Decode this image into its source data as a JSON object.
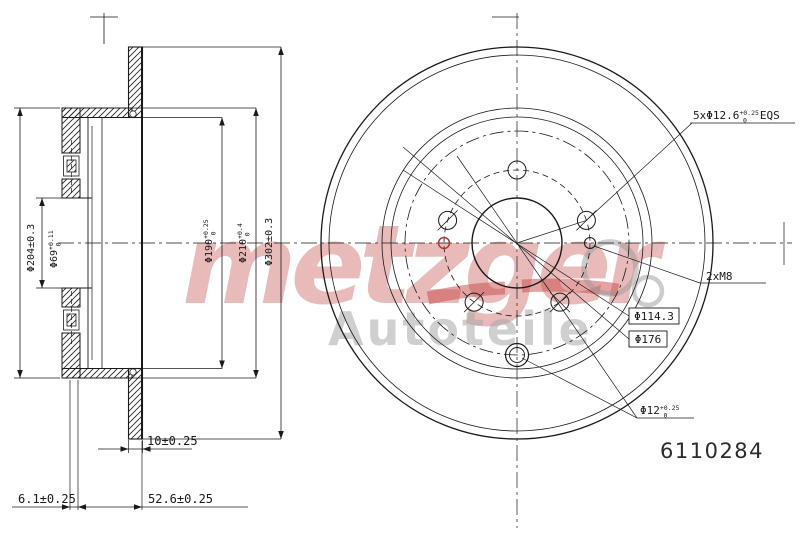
{
  "part_number": "6110284",
  "watermark": {
    "brand": "metzger",
    "subtitle": "Autoteile",
    "brand_color": "#d47878",
    "subtitle_color": "#a8a8a8",
    "swoosh_color": "#c84848",
    "gear_color": "#9a9a9a"
  },
  "section": {
    "hat_outer_diameter": "Φ204±0.3",
    "bore_base": "Φ69",
    "bore_tol_up": "+0.11",
    "bore_tol_low": "0",
    "drum_inner_base": "Φ190",
    "drum_inner_tol_up": "+0.25",
    "drum_inner_tol_low": "0",
    "drum_outer_base": "Φ210",
    "drum_outer_tol_up": "+0.4",
    "drum_outer_tol_low": "0",
    "outer_diameter": "Φ302±0.3",
    "disc_thickness": "10±0.25",
    "hat_face_thickness": "6.1±0.25",
    "overall_height": "52.6±0.25"
  },
  "face": {
    "bolt_holes_base": "5xΦ12.6",
    "bolt_holes_tol_up": "+0.25",
    "bolt_holes_tol_low": "0",
    "bolt_holes_suffix": "EQS",
    "service_thread": "2xM8",
    "pcd_boxed": "Φ114.3",
    "aux_circle_boxed": "Φ176",
    "aux_hole_base": "Φ12",
    "aux_hole_tol_up": "+0.25",
    "aux_hole_tol_low": "0"
  },
  "colors": {
    "line": "#1a1a1a",
    "accent_red": "#b03535"
  }
}
